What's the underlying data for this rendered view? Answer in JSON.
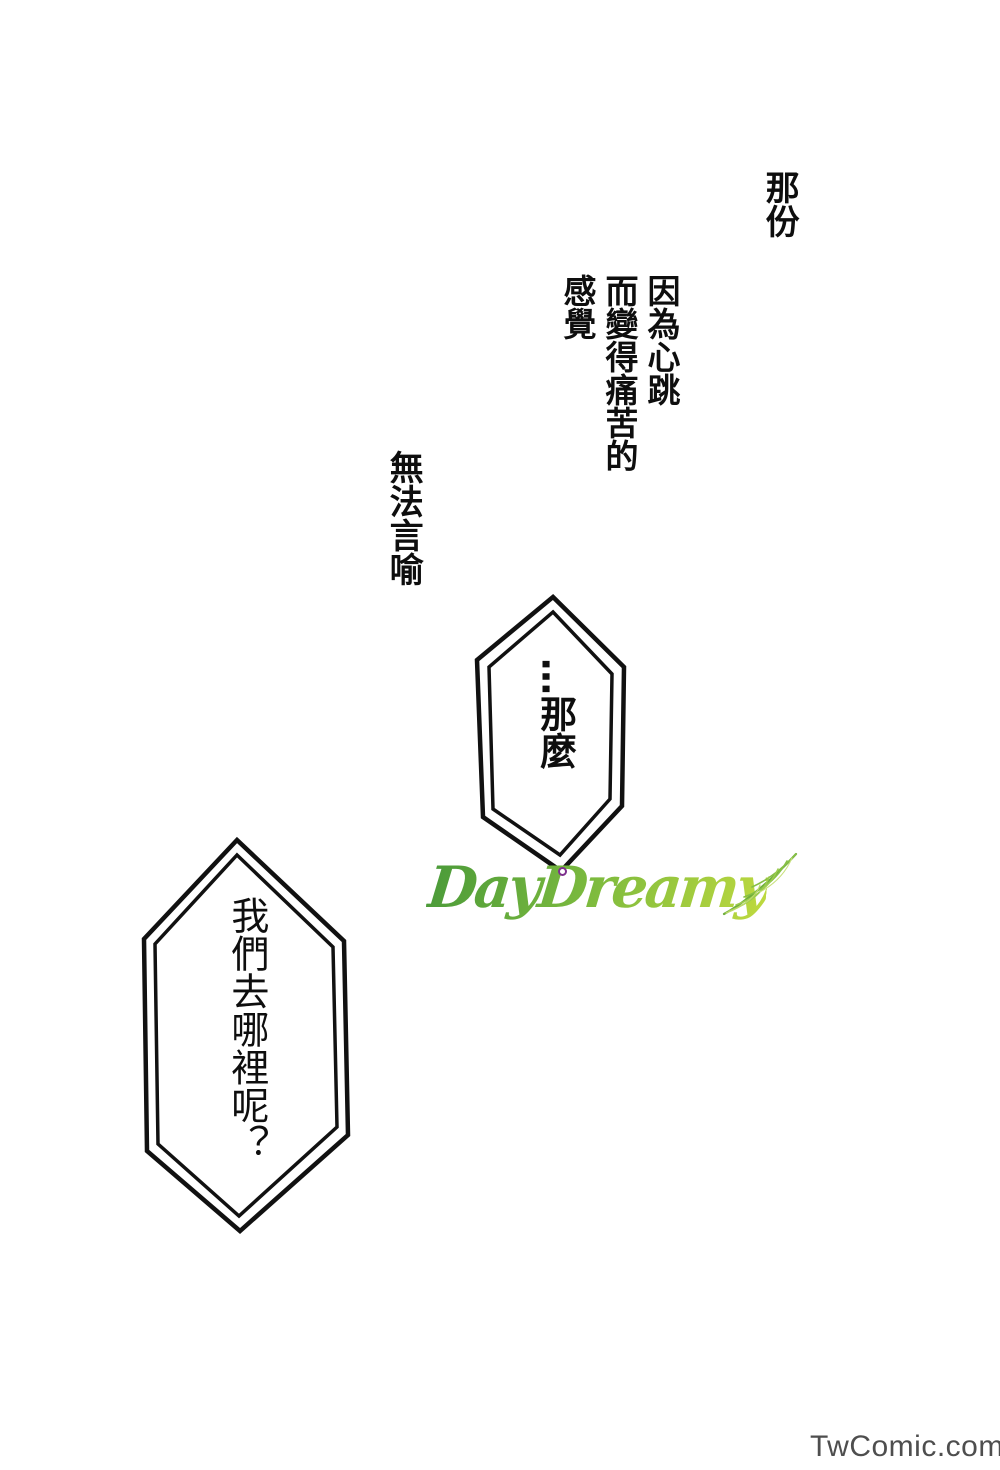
{
  "page": {
    "background": "#ffffff"
  },
  "narration": {
    "line1": "那份",
    "line2_col1": "因為心跳",
    "line2_col2": "而變得痛苦的",
    "line2_col3": "感覺",
    "line3": "無法言喻"
  },
  "bubbles": [
    {
      "text": "…那麼"
    },
    {
      "text": "我們去哪裡呢？"
    }
  ],
  "logo": {
    "text": "DayDreamy",
    "color_start": "#4a9a39",
    "color_mid": "#7cba3e",
    "color_end": "#bed93f",
    "accent_color": "#7d2f8d"
  },
  "watermark": {
    "text": "TwComic.com",
    "color": "#4e4e4e"
  }
}
